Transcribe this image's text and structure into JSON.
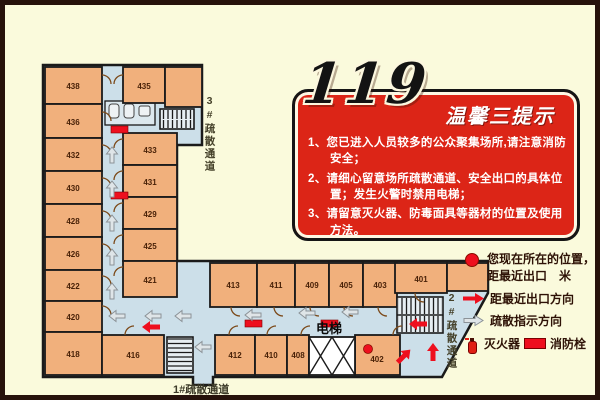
{
  "colors": {
    "background": "#fafadc",
    "frame": "#26120b",
    "room_fill": "#f1b07c",
    "corridor_fill": "#ccdfe9",
    "wall": "#1a1a1a",
    "sign_red": "#dc2517",
    "accent_red": "#ee0f1e",
    "legend_text": "#2e1206"
  },
  "notice": {
    "big_number": "119",
    "title": "温馨三提示",
    "tips": [
      "1、您已进入人员较多的公众聚集场所,请注意消防安全；",
      "2、请细心留意场所疏散通道、安全出口的具体位置；发生火警时禁用电梯；",
      "3、请留意灭火器、防毒面具等器材的位置及使用方法。"
    ]
  },
  "legend": {
    "location_line1": "您现在所在的位置，",
    "location_line2": "距最近出口　米",
    "exit_direction": "距最近出口方向",
    "evac_direction": "疏散指示方向",
    "extinguisher": "灭火器",
    "hydrant": "消防栓"
  },
  "plan": {
    "west_rooms": [
      "438",
      "436",
      "432",
      "430",
      "428",
      "426",
      "422",
      "420",
      "418"
    ],
    "east_rooms": [
      "435",
      "433",
      "431",
      "429",
      "425",
      "421"
    ],
    "south_top_rooms": [
      "413",
      "411",
      "409",
      "405",
      "403",
      "401"
    ],
    "south_bottom_rooms": [
      "416",
      "412",
      "410",
      "408",
      "402"
    ],
    "elevator_label": "电梯",
    "exit1_label": "1#疏散通道",
    "exit2_label": "2#疏散通道",
    "exit3_label": "3#疏散通道"
  }
}
